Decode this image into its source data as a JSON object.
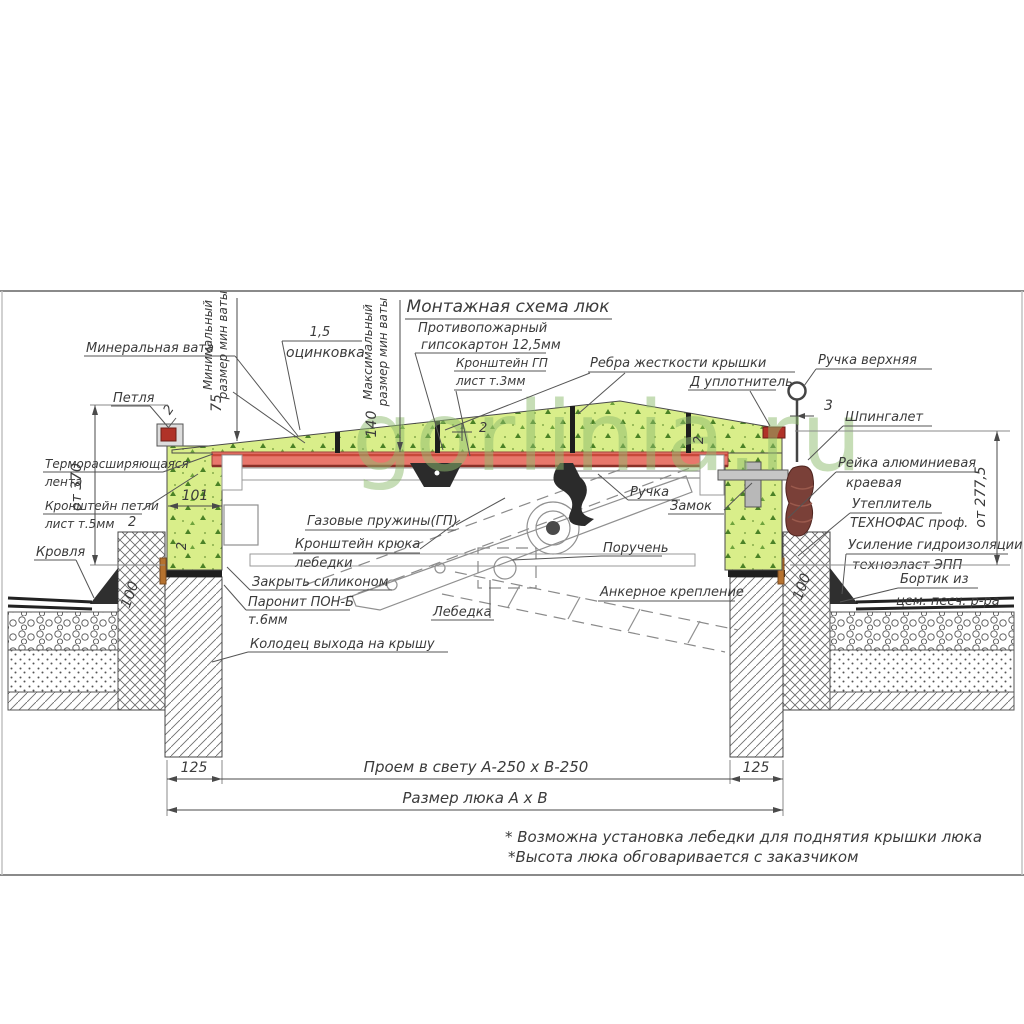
{
  "title": "Монтажная схема люк",
  "watermark": "gorlinia.ru",
  "callouts": {
    "mineral_wool": "Минеральная вата",
    "min_size_l1": "Минимальный",
    "min_size_l2": "размер мин ваты",
    "max_size_l1": "Максимальный",
    "max_size_l2": "размер мин ваты",
    "galv_value": "1,5",
    "galv": "оцинковка",
    "fireproof_l1": "Противопожарный",
    "fireproof_l2": "гипсокартон 12,5мм",
    "gp_bracket_l1": "Кронштейн ГП",
    "gp_bracket_l2": "лист т.3мм",
    "ribs": "Ребра жесткости крышки",
    "d_seal": "Д уплотнитель",
    "top_handle": "Ручка верхняя",
    "latch": "Шпингалет",
    "hinge": "Петля",
    "thermo_l1": "Терморасширяющаяся",
    "thermo_l2": "лента",
    "hinge_bracket_l1": "Кронштейн петли",
    "hinge_bracket_l2": "лист т.5мм",
    "roof": "Кровля",
    "alu_rail_l1": "Рейка алюминиевая",
    "alu_rail_l2": "краевая",
    "insulation_l1": "Утеплитель",
    "insulation_l2": "ТЕХНОФАС проф.",
    "waterproof_l1": "Усиление гидроизоляции",
    "waterproof_l2": "технозласт ЭПП",
    "curb_l1": "Бортик из",
    "curb_l2": "цем. песч. р-ра",
    "silicone": "Закрыть силиконом",
    "paronite_l1": "Паронит ПОН-Б",
    "paronite_l2": "т.6мм",
    "well": "Колодец выхода на крышу",
    "gas_springs": "Газовые пружины(ГП)",
    "winch_bracket_l1": "Кронштейн крюка",
    "winch_bracket_l2": "лебедки",
    "handle": "Ручка",
    "lock": "Замок",
    "handrail": "Поручень",
    "winch": "Лебедка",
    "anchor": "Анкерное крепление"
  },
  "dims": {
    "left_height": "от 370",
    "right_height": "от 277,5",
    "d75": "75",
    "d140": "140",
    "d101": "101",
    "d100": "100",
    "d125": "125",
    "d3": "3",
    "d2": "2",
    "opening": "Проем в свету А-250 х В-250",
    "hatch_size": "Размер люка А х В"
  },
  "notes": {
    "n1": "* Возможна установка лебедки для поднятия крышки люка",
    "n2": "*Высота люка обговаривается с заказчиком"
  },
  "colors": {
    "wool": "#d9ee8a",
    "wool_speckle": "#4b8226",
    "gypsum_red": "#e8776c",
    "handle_brown": "#7a4038",
    "line": "#4a4a4a",
    "watermark": "#8fbc6f"
  }
}
